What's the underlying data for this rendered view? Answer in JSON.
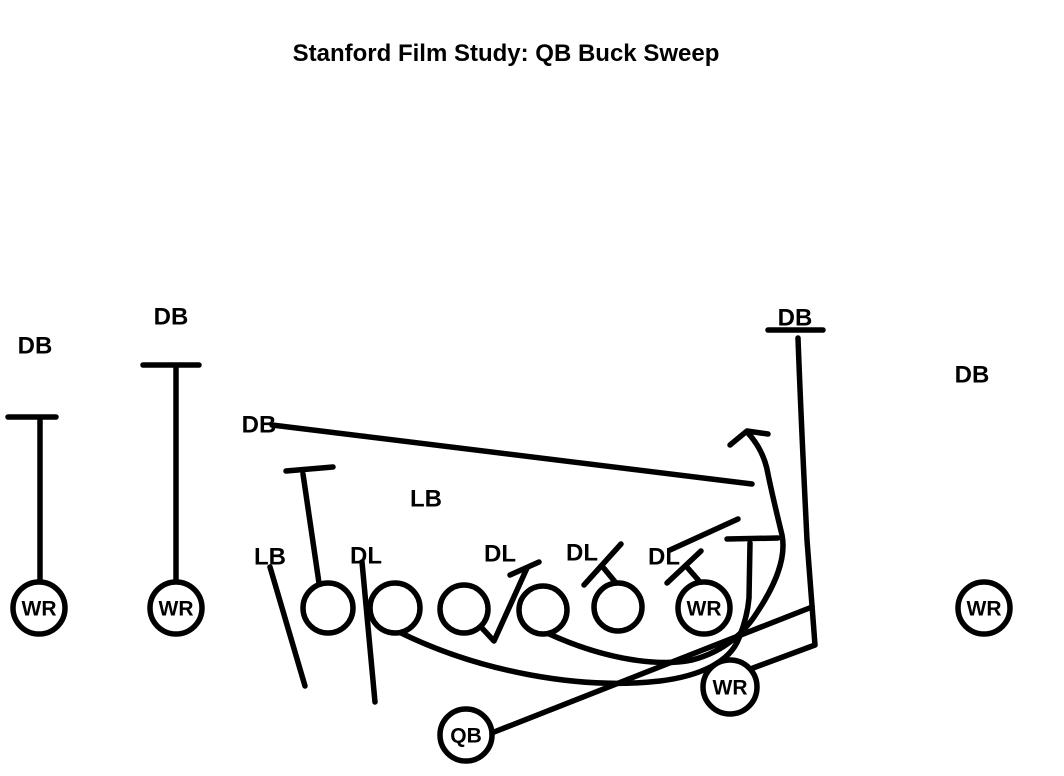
{
  "title": "Stanford Film Study: QB Buck Sweep",
  "colors": {
    "ink": "#000000",
    "background": "#ffffff"
  },
  "canvas": {
    "width": 1064,
    "height": 776
  },
  "players": [
    {
      "id": "wr-far-left",
      "label": "WR",
      "x": 39,
      "y": 608,
      "r": 26
    },
    {
      "id": "wr-left",
      "label": "WR",
      "x": 176,
      "y": 608,
      "r": 26
    },
    {
      "id": "ol-tackle-left",
      "label": "",
      "x": 328,
      "y": 608,
      "r": 25
    },
    {
      "id": "ol-guard-left",
      "label": "",
      "x": 395,
      "y": 608,
      "r": 25
    },
    {
      "id": "ol-center",
      "label": "",
      "x": 464,
      "y": 609,
      "r": 24
    },
    {
      "id": "ol-guard-right",
      "label": "",
      "x": 543,
      "y": 610,
      "r": 24
    },
    {
      "id": "ol-tackle-right",
      "label": "",
      "x": 618,
      "y": 607,
      "r": 24
    },
    {
      "id": "wr-slot-right",
      "label": "WR",
      "x": 704,
      "y": 608,
      "r": 26
    },
    {
      "id": "wr-wing",
      "label": "WR",
      "x": 730,
      "y": 687,
      "r": 27
    },
    {
      "id": "qb",
      "label": "QB",
      "x": 466,
      "y": 735,
      "r": 26
    },
    {
      "id": "wr-far-right",
      "label": "WR",
      "x": 984,
      "y": 608,
      "r": 26
    }
  ],
  "defenders": [
    {
      "id": "db-far-left",
      "label": "DB",
      "x": 35,
      "y": 345
    },
    {
      "id": "db-left",
      "label": "DB",
      "x": 171,
      "y": 316
    },
    {
      "id": "db-middle",
      "label": "DB",
      "x": 259,
      "y": 424
    },
    {
      "id": "db-top-right",
      "label": "DB",
      "x": 795,
      "y": 317
    },
    {
      "id": "db-far-right",
      "label": "DB",
      "x": 972,
      "y": 374
    },
    {
      "id": "lb-middle",
      "label": "LB",
      "x": 426,
      "y": 498
    },
    {
      "id": "lb-left",
      "label": "LB",
      "x": 270,
      "y": 556
    },
    {
      "id": "dl-1",
      "label": "DL",
      "x": 366,
      "y": 555
    },
    {
      "id": "dl-2",
      "label": "DL",
      "x": 500,
      "y": 553
    },
    {
      "id": "dl-3",
      "label": "DL",
      "x": 582,
      "y": 552
    },
    {
      "id": "dl-4",
      "label": "DL",
      "x": 664,
      "y": 556
    }
  ],
  "routes": [
    {
      "id": "wr-far-left-stalk-block",
      "d": "M40,582 L40,420 M8,417 L56,417"
    },
    {
      "id": "wr-left-stalk-block",
      "d": "M176,582 L176,368 M143,365 L199,365"
    },
    {
      "id": "db-middle-pursuit",
      "d": "M272,425 L752,484"
    },
    {
      "id": "ol-tackle-left-climb-block",
      "d": "M319,583 L303,474 M286,471 L333,467"
    },
    {
      "id": "lb-left-flow",
      "d": "M270,567 L305,686"
    },
    {
      "id": "dl-1-penetration",
      "d": "M362,562 L375,702"
    },
    {
      "id": "ol-center-down-block",
      "d": "M481,627 L494,641 L527,568 M510,575 L539,562"
    },
    {
      "id": "ol-tackle-right-block",
      "d": "M616,583 L602,566 M584,585 L621,544"
    },
    {
      "id": "wr-slot-right-block",
      "d": "M700,582 L686,566 M667,583 L701,551"
    },
    {
      "id": "edge-diagonal",
      "d": "M670,550 L738,519"
    },
    {
      "id": "wr-wing-crack-route",
      "d": "M753,668 L815,645 L807,540 C804,478 801,420 798,338 M768,330 L823,330"
    },
    {
      "id": "pull-wrap-block",
      "d": "M399,632 C480,672 580,690 660,681 C700,676 730,662 739,638 C745,623 748,610 749,598 L750,543 M727,539 L778,538"
    },
    {
      "id": "pull-sweep-arrow",
      "d": "M547,633 C610,662 662,666 692,660 C727,651 747,629 758,611 C773,588 787,560 782,535 C777,514 772,494 768,474 C765,456 757,443 748,433 M730,445 L747,431 L768,434"
    },
    {
      "id": "qb-sweep-path",
      "d": "M489,734 L812,607"
    }
  ],
  "style": {
    "line_width": 5.5,
    "circle_line_width": 5.5,
    "label_font_size": 24,
    "circle_font_size": 21
  }
}
